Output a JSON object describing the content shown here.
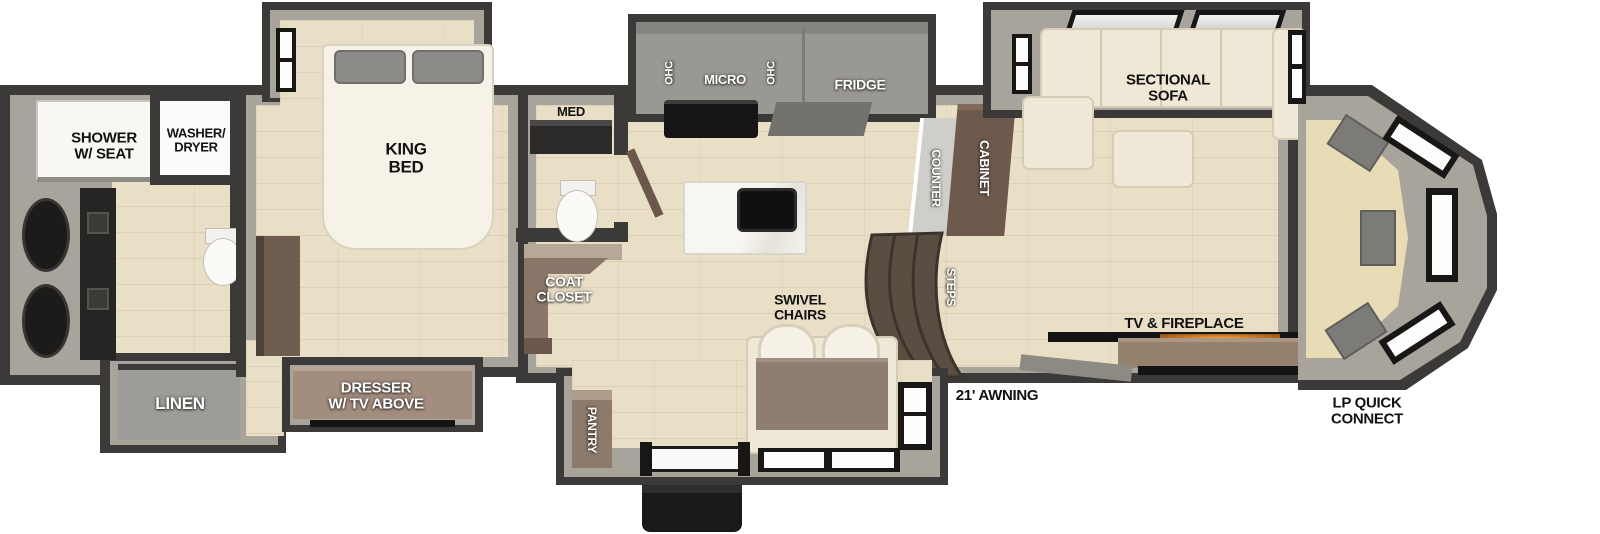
{
  "labels": {
    "shower": "SHOWER\nW/ SEAT",
    "washer_dryer": "WASHER/\nDRYER",
    "linen": "LINEN",
    "king_bed": "KING\nBED",
    "dresser": "DRESSER\nW/ TV ABOVE",
    "med": "MED",
    "coat_closet": "COAT\nCLOSET",
    "ohc_left": "OHC",
    "micro": "MICRO",
    "ohc_right": "OHC",
    "fridge": "FRIDGE",
    "counter": "COUNTER",
    "cabinet": "CABINET",
    "steps": "STEPS",
    "sectional_sofa": "SECTIONAL\nSOFA",
    "swivel_chairs": "SWIVEL\nCHAIRS",
    "pantry": "PANTRY",
    "tv_fireplace": "TV & FIREPLACE",
    "awning": "21' AWNING",
    "lp_quick_connect": "LP QUICK\nCONNECT"
  },
  "palette": {
    "wall_dark": "#3b3a38",
    "wall_gray": "#a8a49b",
    "floor_wood": "#e9dfc7",
    "furniture_cream": "#efe8d6",
    "cabinet_brown": "#6e5a4c",
    "dresser_tan": "#a28d7e",
    "appliance_gray": "#9a9892",
    "fixture_black": "#161616",
    "fireplace_glow": "#f29b36",
    "rear_seat_beige": "#e8dcb6"
  }
}
